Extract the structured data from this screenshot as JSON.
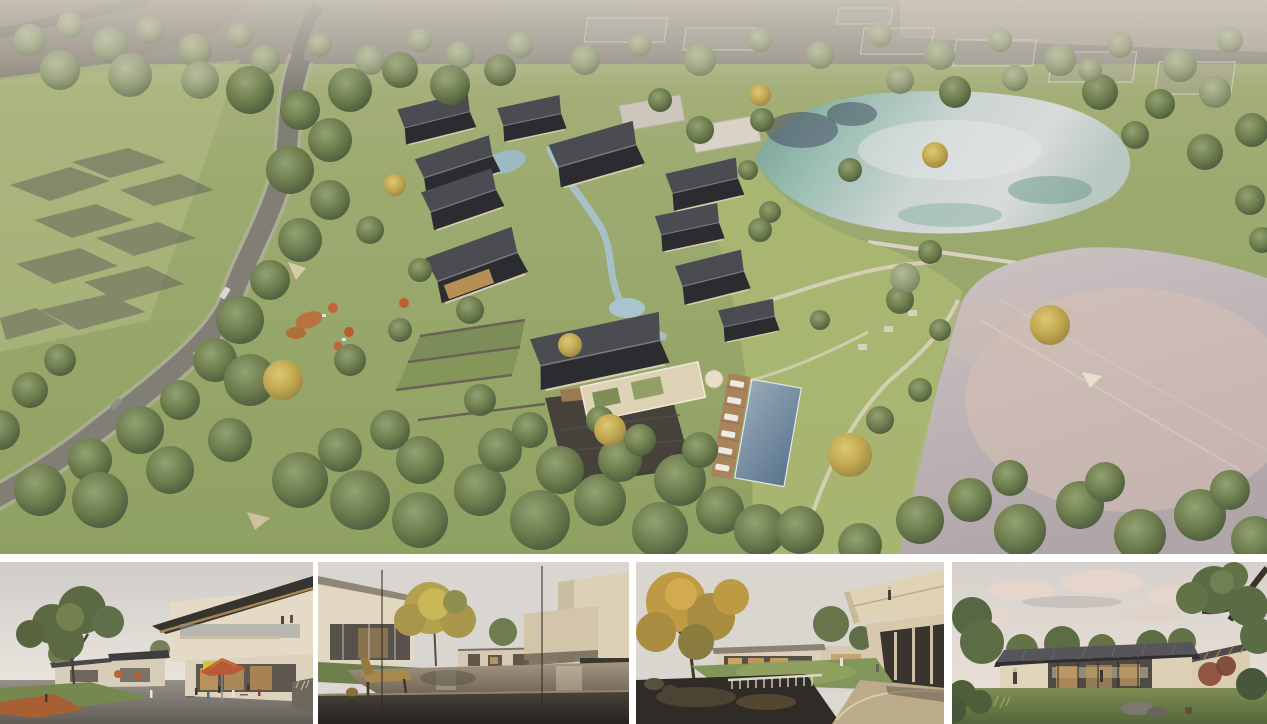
{
  "board": {
    "background": "#ffffff",
    "panels": {
      "main": {
        "id": "aerial-site-render",
        "alt": "Aerial rendering of a hillside resort village: beige courtyard houses with dark gabled roofs around a stream, stone plaza and swimming pool, a winding grey road through dense tree canopy on the left, translucent future-phase volumes at the top, and two ponds separated by a grass causeway with pink evening reflections on the right."
      },
      "thumbnails": [
        {
          "id": "street-cafe-view",
          "alt": "Eye-level rendering of a two-storey timber and stucco building with a tilted roof, a yellow shop sign, terracotta cafe umbrellas, outdoor diners and a large green tree on the left."
        },
        {
          "id": "reflecting-pond-courtyard",
          "alt": "Courtyard rendering seen through a glass wall: a wooden bench and stool on a dark deck before a shallow reflecting pond, beige houses, a golden tree and two figures in red coats on the right."
        },
        {
          "id": "waterfall-garden-courtyard",
          "alt": "Garden courtyard rendering with a golden autumn tree, a dark pond spilling over a stone weir, lawns between low pavilions and a cantilevered roof terrace with a standing figure."
        },
        {
          "id": "lawn-pavilion-view",
          "alt": "Rendering of a single-storey glazed pavilion with a dark standing-seam roof and timber rafters on a lawn, framed by mature trees under a pale pink evening sky."
        }
      ]
    },
    "palette": {
      "canvas": "#ffffff",
      "grass": "#93a566",
      "foliage_dark": "#55663f",
      "foliage_hazy": "#8a9478",
      "foliage_autumn": "#c2a94e",
      "roof_dark": "#2f3034",
      "wall_beige": "#dbd0b5",
      "road_grey": "#83807a",
      "pond_teal": "#7fae9c",
      "pond_pale": "#d2d6d6",
      "lake_mauve": "#b9aeb0",
      "lake_pink": "#d9c4b8",
      "pool_blue": "#6c84a0",
      "umbrella_terracotta": "#c2633a",
      "sky_haze": "#dcd8d2"
    }
  }
}
